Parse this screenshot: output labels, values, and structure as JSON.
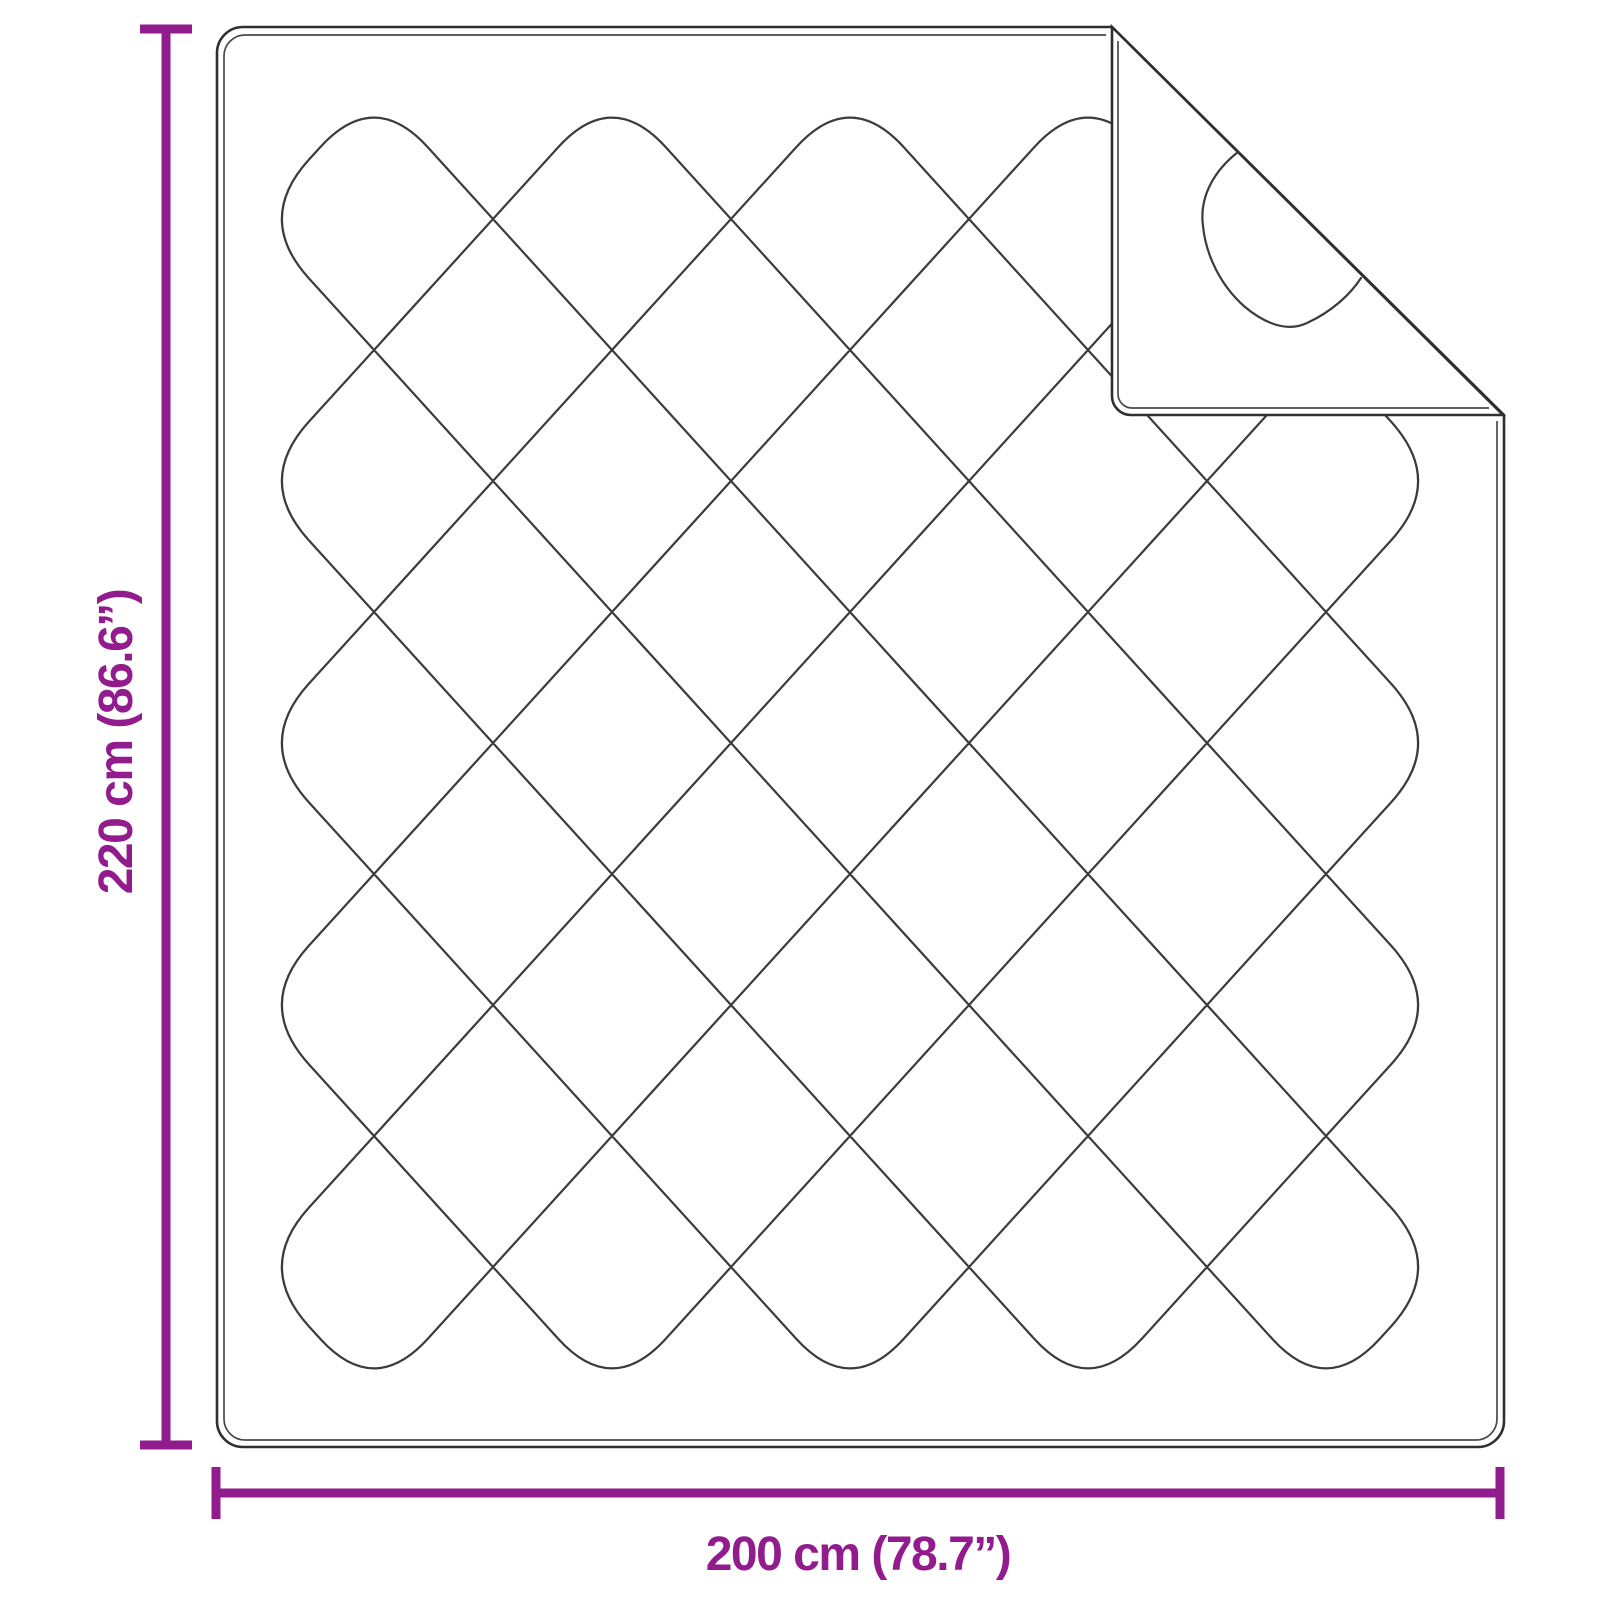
{
  "diagram": {
    "product": "quilted-blanket-with-folded-corner",
    "dimensions": {
      "height": {
        "label": "220 cm (86.6”)",
        "value_cm": 220,
        "value_in": 86.6
      },
      "width": {
        "label": "200 cm (78.7”)",
        "value_cm": 200,
        "value_in": 78.7
      }
    },
    "colors": {
      "accent": "#921c8d",
      "outline": "#2f2f2f",
      "stitch": "#3b3b3b",
      "background": "#ffffff"
    }
  }
}
